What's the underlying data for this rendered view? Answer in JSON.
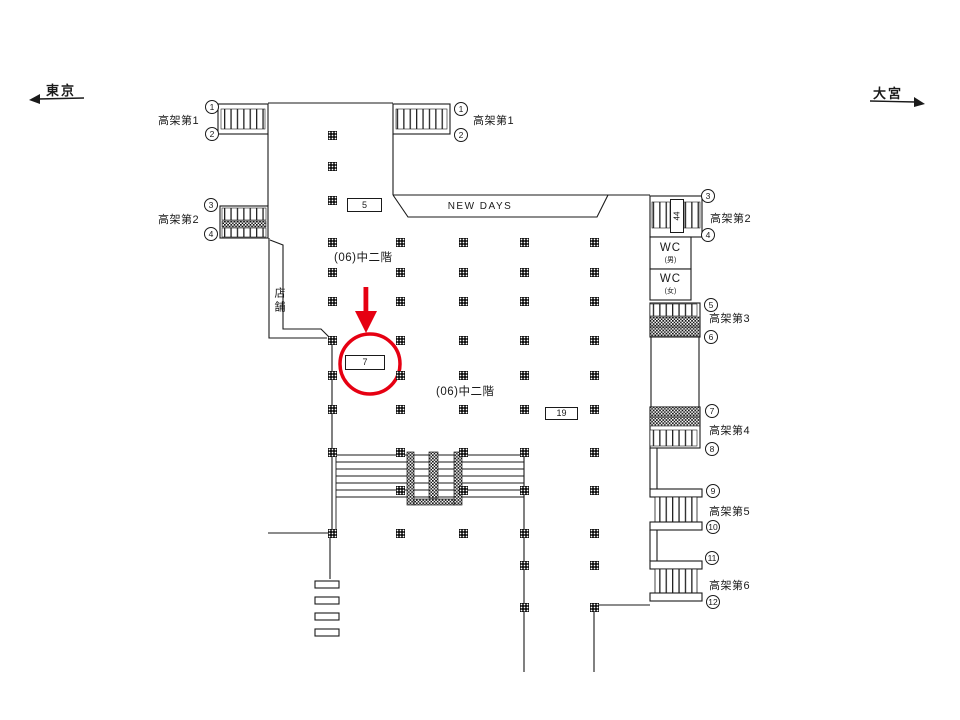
{
  "directions": {
    "left": {
      "label": "東京"
    },
    "right": {
      "label": "大宮"
    }
  },
  "area_labels": {
    "new_days": "NEW DAYS",
    "mezzanine_upper": "(06)中二階",
    "mezzanine_lower": "(06)中二階",
    "shop": "店舗",
    "wc_men": {
      "title": "WC",
      "gender": "(男)"
    },
    "wc_women": {
      "title": "WC",
      "gender": "(女)"
    }
  },
  "stairways": {
    "kouka1_left": {
      "label": "高架第1",
      "num_top": "1",
      "num_bottom": "2"
    },
    "kouka1_top": {
      "label": "高架第1",
      "num_top": "1",
      "num_bottom": "2"
    },
    "kouka2_left": {
      "label": "高架第2",
      "num_top": "3",
      "num_bottom": "4"
    },
    "kouka2_right": {
      "label": "高架第2",
      "num_top": "3",
      "num_bottom": "4"
    },
    "kouka3_right": {
      "label": "高架第3",
      "num_top": "5",
      "num_bottom": "6"
    },
    "kouka4_right": {
      "label": "高架第4",
      "num_top": "7",
      "num_bottom": "8"
    },
    "kouka5_right": {
      "label": "高架第5",
      "num_top": "9",
      "num_bottom": "10"
    },
    "kouka6_right": {
      "label": "高架第6",
      "num_top": "11",
      "num_bottom": "12"
    }
  },
  "ad_signs": {
    "sign_5": "5",
    "sign_7": "7",
    "sign_19": "19",
    "sign_44": "44"
  },
  "highlight": {
    "target_sign": "7",
    "color": "#e60012"
  },
  "colors": {
    "line": "#1a1a1a",
    "background": "#ffffff",
    "red": "#e60012"
  }
}
